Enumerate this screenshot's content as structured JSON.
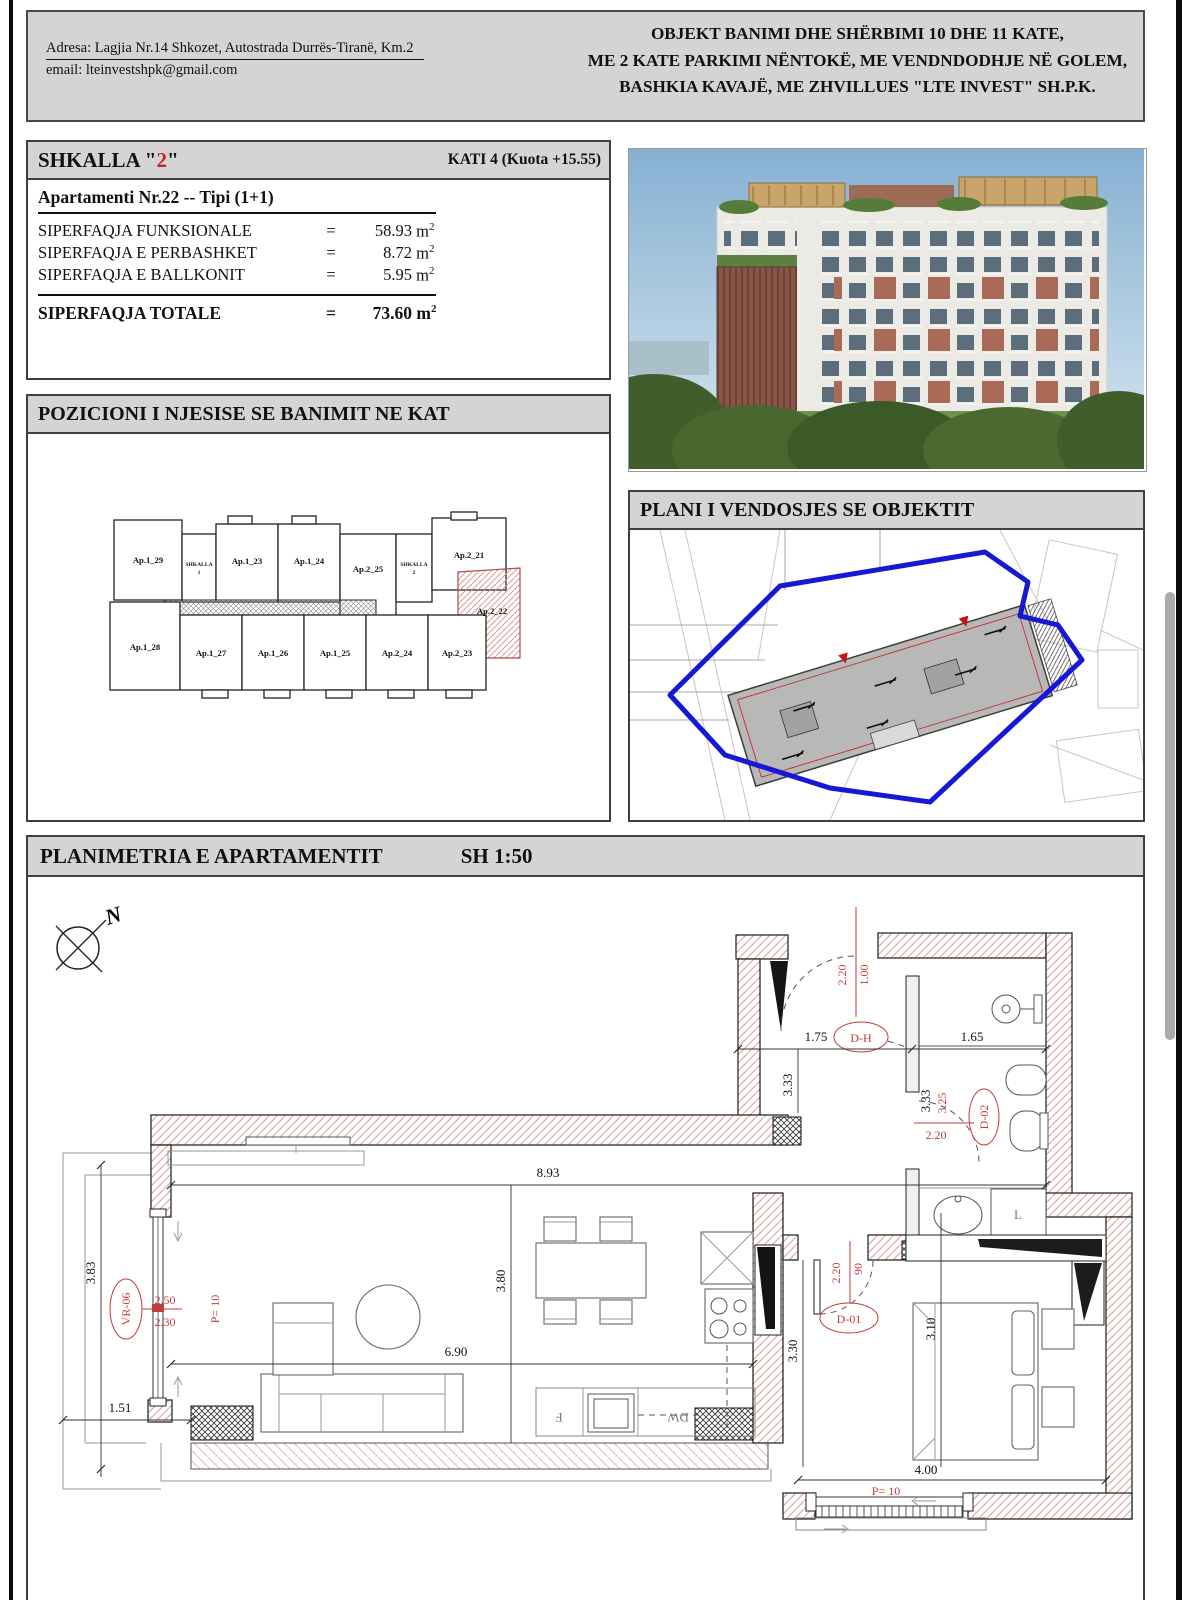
{
  "header": {
    "address": "Adresa: Lagjia Nr.14 Shkozet, Autostrada Durrës-Tiranë, Km.2",
    "email": "email: lteinvestshpk@gmail.com",
    "title_line1": "OBJEKT BANIMI DHE SHËRBIMI 10 DHE 11 KATE,",
    "title_line2": "ME 2 KATE PARKIMI NËNTOKË, ME VENDNDODHJE NË GOLEM,",
    "title_line3": "BASHKIA KAVAJË, ME ZHVILLUES \"LTE INVEST\" SH.P.K."
  },
  "unit_card": {
    "stair_prefix": "SHKALLA \"",
    "stair_num": "2",
    "stair_suffix": "\"",
    "floor": "KATI 4 (Kuota +15.55)",
    "apartment": "Apartamenti Nr.22 -- Tipi (1+1)",
    "eq": "=",
    "unit": "m",
    "sup": "2",
    "rows": [
      {
        "label": "SIPERFAQJA FUNKSIONALE",
        "value": "58.93"
      },
      {
        "label": "SIPERFAQJA E PERBASHKET",
        "value": "8.72"
      },
      {
        "label": "SIPERFAQJA E BALLKONIT",
        "value": "5.95"
      }
    ],
    "total_label": "SIPERFAQJA TOTALE",
    "total_value": "73.60"
  },
  "position_section": {
    "title": "POZICIONI I NJESISE SE BANIMIT NE KAT",
    "units": {
      "a129": "Ap.1_29",
      "a123": "Ap.1_23",
      "a124": "Ap.1_24",
      "a225": "Ap.2_25",
      "a221": "Ap.2_21",
      "a222": "Ap.2_22",
      "a128": "Ap.1_28",
      "a127": "Ap.1_27",
      "a126": "Ap.1_26",
      "a125": "Ap.1_25",
      "a224": "Ap.2_24",
      "a223": "Ap.2_23",
      "stair_word": "SHKALLA",
      "stair1_num": "1",
      "stair2_num": "2"
    }
  },
  "site_section": {
    "title": "PLANI I VENDOSJES SE OBJEKTIT"
  },
  "plan_section": {
    "title": "PLANIMETRIA E APARTAMENTIT",
    "scale": "SH 1:50",
    "north": "N",
    "dims": {
      "d893": "8.93",
      "d380": "3.80",
      "d690": "6.90",
      "d151": "1.51",
      "d383": "3.83",
      "d175": "1.75",
      "d165": "1.65",
      "d333a": "3.33",
      "d333b": "3.33",
      "d330": "3.30",
      "d310": "3.10",
      "d400": "4.00"
    },
    "doors": {
      "dh": {
        "id": "D-H",
        "width": "1.00",
        "height": "2.20"
      },
      "d01": {
        "id": "D-01",
        "width": "90",
        "height": "2.20"
      },
      "d02": {
        "id": "D-02",
        "line1": "3.25",
        "height": "2.20"
      }
    },
    "windows": {
      "vr06": {
        "id": "VR-06",
        "line1": "2.50",
        "line2": "2.30",
        "p": "P= 10"
      },
      "bottom": {
        "p": "P= 10"
      }
    },
    "labels": {
      "laundry": "L",
      "fridge": "F",
      "dishwasher": "DW"
    }
  },
  "colors": {
    "accent_red": "#cc2222",
    "site_boundary_blue": "#1717d6",
    "wall_hatch_pink": "#e0a8a8",
    "panel_gray": "#d4d4d4"
  }
}
